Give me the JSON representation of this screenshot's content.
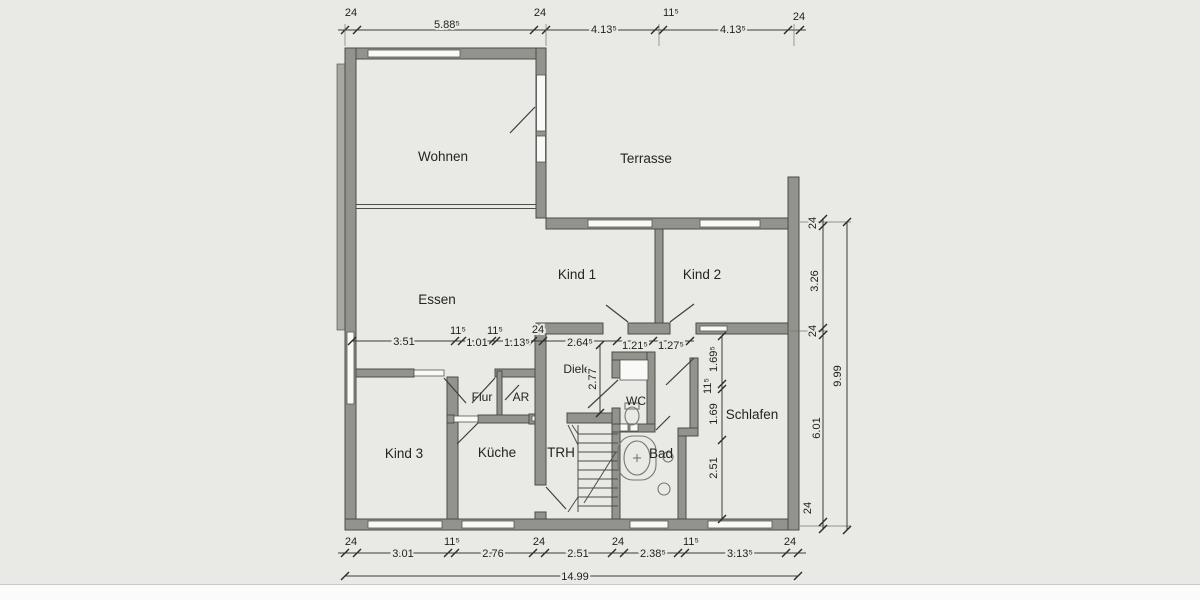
{
  "rooms": {
    "wohnen": "Wohnen",
    "terrasse": "Terrasse",
    "essen": "Essen",
    "kind1": "Kind 1",
    "kind2": "Kind 2",
    "kind3": "Kind 3",
    "flur": "Flur",
    "ar": "AR",
    "kueche": "Küche",
    "trh": "TRH",
    "diele": "Diele",
    "wc": "WC",
    "bad": "Bad",
    "schlafen": "Schlafen"
  },
  "dims": {
    "top": [
      "24",
      "5.88⁵",
      "24",
      "4.13⁵",
      "11⁵",
      "4.13⁵",
      "24"
    ],
    "middle": [
      "3.51",
      "11⁵",
      "1.01",
      "11⁵",
      "1.13⁵",
      "24",
      "2.64⁵",
      "1.21⁵",
      "1.27⁵"
    ],
    "bottom": [
      "24",
      "3.01",
      "11⁵",
      "2.76",
      "24",
      "2.51",
      "24",
      "2.38⁵",
      "11⁵",
      "3.13⁵",
      "24"
    ],
    "bottom_total": "14.99",
    "right": [
      "24",
      "3.26",
      "24",
      "6.01",
      "24"
    ],
    "right_total": "9.99",
    "diele_depth": "2.77",
    "schlafen_chain": [
      "1.69⁵",
      "11⁵",
      "1.69",
      "2.51"
    ]
  },
  "colors": {
    "background": "#e9e9e6",
    "wall": "#93938d",
    "window": "#f9f9f7",
    "text": "#242422"
  }
}
